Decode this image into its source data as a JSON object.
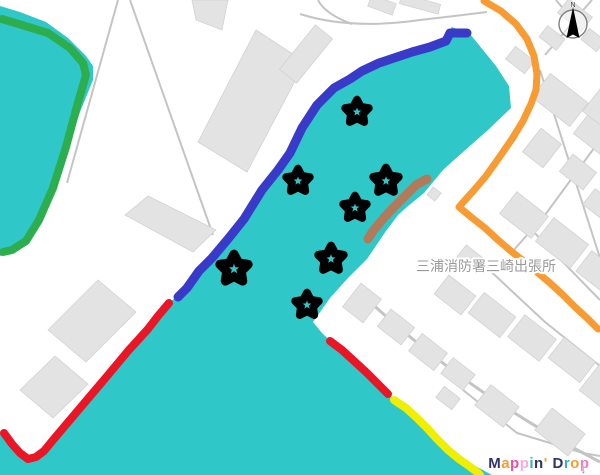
{
  "app": {
    "logo_letters": [
      {
        "ch": "M",
        "color": "#303264"
      },
      {
        "ch": "a",
        "color": "#F49D2C"
      },
      {
        "ch": "p",
        "color": "#EE4FA4"
      },
      {
        "ch": "p",
        "color": "#F7AEDC"
      },
      {
        "ch": "i",
        "color": "#33B6B2"
      },
      {
        "ch": "n",
        "color": "#303264"
      },
      {
        "ch": "'",
        "color": "#F49D2C"
      },
      {
        "ch": " ",
        "color": "#303264"
      },
      {
        "ch": "D",
        "color": "#303264"
      },
      {
        "ch": "r",
        "color": "#33B6B2"
      },
      {
        "ch": "o",
        "color": "#F49D2C"
      },
      {
        "ch": "p",
        "color": "#EE7BC8"
      }
    ],
    "logo_arrow": {
      "glyph": "↓",
      "color": "#33B6B2"
    }
  },
  "map": {
    "colors": {
      "water": "#2FC7C8",
      "land": "#FFFFFF",
      "building_fill": "#E3E3E3",
      "building_stroke": "#D2D2D2",
      "road": "#C4C4C4",
      "marker": "#000000"
    },
    "water_polygons": [
      {
        "name": "harbor-water",
        "points": [
          [
            452,
            27
          ],
          [
            470,
            34
          ],
          [
            496,
            66
          ],
          [
            509,
            86
          ],
          [
            511,
            108
          ],
          [
            488,
            130
          ],
          [
            463,
            152
          ],
          [
            443,
            170
          ],
          [
            424,
            193
          ],
          [
            408,
            206
          ],
          [
            398,
            215
          ],
          [
            386,
            231
          ],
          [
            367,
            259
          ],
          [
            348,
            278
          ],
          [
            330,
            298
          ],
          [
            313,
            322
          ],
          [
            322,
            333
          ],
          [
            342,
            352
          ],
          [
            365,
            372
          ],
          [
            390,
            397
          ],
          [
            418,
            424
          ],
          [
            443,
            444
          ],
          [
            468,
            462
          ],
          [
            492,
            475
          ],
          [
            0,
            475
          ],
          [
            0,
            434
          ],
          [
            12,
            441
          ],
          [
            24,
            452
          ],
          [
            35,
            458
          ],
          [
            45,
            454
          ],
          [
            56,
            442
          ],
          [
            70,
            424
          ],
          [
            90,
            400
          ],
          [
            110,
            372
          ],
          [
            131,
            347
          ],
          [
            152,
            326
          ],
          [
            168,
            303
          ],
          [
            178,
            296
          ],
          [
            191,
            279
          ],
          [
            202,
            270
          ],
          [
            213,
            257
          ],
          [
            227,
            238
          ],
          [
            243,
            218
          ],
          [
            262,
            188
          ],
          [
            278,
            167
          ],
          [
            289,
            154
          ],
          [
            301,
            128
          ],
          [
            317,
            103
          ],
          [
            334,
            86
          ],
          [
            350,
            77
          ],
          [
            362,
            69
          ],
          [
            379,
            60
          ],
          [
            394,
            56
          ],
          [
            413,
            49
          ],
          [
            431,
            44
          ],
          [
            447,
            40
          ],
          [
            447,
            33
          ]
        ]
      },
      {
        "name": "west-water",
        "points": [
          [
            0,
            6
          ],
          [
            20,
            12
          ],
          [
            46,
            22
          ],
          [
            68,
            38
          ],
          [
            86,
            56
          ],
          [
            93,
            66
          ],
          [
            93,
            80
          ],
          [
            80,
            112
          ],
          [
            68,
            150
          ],
          [
            55,
            190
          ],
          [
            40,
            222
          ],
          [
            25,
            243
          ],
          [
            10,
            252
          ],
          [
            0,
            256
          ]
        ]
      }
    ],
    "roads": [
      {
        "d": "M300,14 Q350,30 420,20 Q455,16 487,12",
        "w": 2
      },
      {
        "d": "M318,0 Q325,14 352,24",
        "w": 2
      },
      {
        "d": "M118,0 L67,183",
        "w": 2
      },
      {
        "d": "M130,0 L213,235",
        "w": 2
      },
      {
        "d": "M368,300 Q470,395 600,462",
        "w": 3
      },
      {
        "d": "M463,390 L517,433 L583,453 L600,456",
        "w": 2
      },
      {
        "d": "M540,70 L575,180 L600,258",
        "w": 2
      },
      {
        "d": "M520,218 L600,300",
        "w": 2
      },
      {
        "d": "M470,252 L545,322 L600,366",
        "w": 2
      },
      {
        "d": "M600,140 L545,215 L512,252",
        "w": 2
      },
      {
        "d": "M545,55 L578,16 L592,0",
        "w": 2
      },
      {
        "d": "M556,0 L571,18",
        "w": 2
      }
    ],
    "building_polygons": [
      [
        [
          198,
          142
        ],
        [
          256,
          30
        ],
        [
          305,
          62
        ],
        [
          247,
          172
        ]
      ],
      [
        [
          125,
          215
        ],
        [
          148,
          196
        ],
        [
          216,
          230
        ],
        [
          193,
          252
        ]
      ],
      [
        [
          48,
          330
        ],
        [
          98,
          280
        ],
        [
          136,
          312
        ],
        [
          86,
          362
        ]
      ],
      [
        [
          20,
          390
        ],
        [
          55,
          356
        ],
        [
          88,
          384
        ],
        [
          53,
          418
        ]
      ],
      [
        [
          192,
          0
        ],
        [
          228,
          0
        ],
        [
          222,
          30
        ],
        [
          196,
          20
        ]
      ]
    ],
    "building_rects": [
      [
        306,
        54,
        57,
        22,
        -51
      ],
      [
        382,
        5,
        26,
        12,
        20
      ],
      [
        420,
        4,
        40,
        10,
        15
      ],
      [
        575,
        15,
        30,
        18,
        38
      ],
      [
        552,
        38,
        22,
        14,
        38
      ],
      [
        593,
        40,
        20,
        14,
        38
      ],
      [
        560,
        100,
        48,
        30,
        38
      ],
      [
        595,
        135,
        36,
        24,
        38
      ],
      [
        542,
        148,
        26,
        30,
        38
      ],
      [
        578,
        172,
        30,
        22,
        38
      ],
      [
        604,
        105,
        26,
        36,
        38
      ],
      [
        520,
        60,
        24,
        16,
        38
      ],
      [
        524,
        215,
        40,
        28,
        38
      ],
      [
        562,
        243,
        44,
        30,
        38
      ],
      [
        598,
        272,
        36,
        26,
        38
      ],
      [
        600,
        205,
        28,
        20,
        38
      ],
      [
        470,
        258,
        22,
        16,
        38
      ],
      [
        455,
        295,
        34,
        24,
        38
      ],
      [
        492,
        315,
        40,
        26,
        38
      ],
      [
        532,
        338,
        40,
        28,
        38
      ],
      [
        572,
        360,
        40,
        26,
        38
      ],
      [
        605,
        385,
        34,
        40,
        38
      ],
      [
        362,
        303,
        26,
        30,
        38
      ],
      [
        396,
        327,
        30,
        22,
        38
      ],
      [
        428,
        352,
        32,
        22,
        38
      ],
      [
        458,
        374,
        28,
        20,
        38
      ],
      [
        497,
        406,
        36,
        26,
        38
      ],
      [
        560,
        432,
        42,
        28,
        38
      ],
      [
        448,
        398,
        20,
        14,
        38
      ],
      [
        434,
        194,
        10,
        10,
        38
      ]
    ],
    "routes": [
      {
        "name": "green-route",
        "color": "#2CAE4F",
        "width": 8,
        "points": [
          [
            2,
            19
          ],
          [
            22,
            25
          ],
          [
            48,
            33
          ],
          [
            70,
            48
          ],
          [
            83,
            63
          ],
          [
            86,
            75
          ],
          [
            77,
            106
          ],
          [
            66,
            147
          ],
          [
            53,
            188
          ],
          [
            39,
            220
          ],
          [
            26,
            241
          ],
          [
            12,
            250
          ],
          [
            3,
            252
          ]
        ]
      },
      {
        "name": "blue-route",
        "color": "#3A3AC8",
        "width": 9,
        "points": [
          [
            467,
            33
          ],
          [
            450,
            33
          ],
          [
            446,
            41
          ],
          [
            430,
            47
          ],
          [
            412,
            52
          ],
          [
            394,
            58
          ],
          [
            379,
            63
          ],
          [
            362,
            71
          ],
          [
            350,
            79
          ],
          [
            334,
            88
          ],
          [
            317,
            105
          ],
          [
            302,
            128
          ],
          [
            290,
            153
          ],
          [
            278,
            170
          ],
          [
            262,
            190
          ],
          [
            244,
            219
          ],
          [
            228,
            239
          ],
          [
            212,
            258
          ],
          [
            199,
            271
          ],
          [
            187,
            288
          ],
          [
            178,
            297
          ]
        ]
      },
      {
        "name": "red-route-west",
        "color": "#EA1525",
        "width": 8,
        "points": [
          [
            169,
            303
          ],
          [
            158,
            316
          ],
          [
            148,
            329
          ],
          [
            128,
            351
          ],
          [
            108,
            375
          ],
          [
            86,
            401
          ],
          [
            64,
            427
          ],
          [
            53,
            440
          ],
          [
            44,
            451
          ],
          [
            36,
            457
          ],
          [
            28,
            459
          ],
          [
            20,
            453
          ],
          [
            12,
            444
          ],
          [
            4,
            433
          ]
        ]
      },
      {
        "name": "red-route-east",
        "color": "#EA1525",
        "width": 8,
        "points": [
          [
            330,
            341
          ],
          [
            342,
            350
          ],
          [
            354,
            361
          ],
          [
            366,
            372
          ],
          [
            378,
            384
          ],
          [
            388,
            394
          ]
        ]
      },
      {
        "name": "yellow-route",
        "color": "#F0EF00",
        "width": 8,
        "points": [
          [
            394,
            400
          ],
          [
            406,
            408
          ],
          [
            417,
            418
          ],
          [
            427,
            428
          ],
          [
            437,
            439
          ],
          [
            448,
            450
          ],
          [
            459,
            459
          ],
          [
            469,
            466
          ],
          [
            477,
            472
          ],
          [
            480,
            475
          ]
        ]
      },
      {
        "name": "orange-route",
        "color": "#F89B33",
        "width": 7,
        "points": [
          [
            484,
            1
          ],
          [
            501,
            11
          ],
          [
            516,
            24
          ],
          [
            527,
            39
          ],
          [
            534,
            56
          ],
          [
            537,
            74
          ],
          [
            536,
            90
          ],
          [
            531,
            104
          ],
          [
            523,
            121
          ],
          [
            512,
            139
          ],
          [
            503,
            152
          ],
          [
            496,
            162
          ],
          [
            486,
            176
          ],
          [
            475,
            189
          ],
          [
            466,
            199
          ],
          [
            459,
            207
          ],
          [
            471,
            217
          ],
          [
            485,
            228
          ],
          [
            498,
            240
          ],
          [
            512,
            252
          ],
          [
            525,
            262
          ],
          [
            538,
            273
          ],
          [
            550,
            283
          ],
          [
            563,
            295
          ],
          [
            575,
            307
          ],
          [
            587,
            318
          ],
          [
            598,
            329
          ]
        ]
      },
      {
        "name": "tan-route",
        "color": "#B17A5B",
        "width": 9,
        "points": [
          [
            427,
            179
          ],
          [
            416,
            185
          ],
          [
            404,
            197
          ],
          [
            392,
            209
          ],
          [
            382,
            220
          ],
          [
            373,
            231
          ],
          [
            368,
            239
          ]
        ]
      }
    ],
    "markers": {
      "shape": "star",
      "color": "#000000",
      "hole_color": "#2FC7C8",
      "positions": [
        [
          357,
          112,
          16
        ],
        [
          298,
          181,
          16
        ],
        [
          386,
          181,
          17
        ],
        [
          355,
          208,
          16
        ],
        [
          234,
          269,
          19
        ],
        [
          331,
          259,
          17
        ],
        [
          307,
          305,
          16
        ]
      ]
    },
    "label": {
      "text": "三浦消防署三崎出張所",
      "x": 486,
      "y": 271,
      "size": 14,
      "color": "#9A9A9A",
      "halo": "#FFFFFF"
    },
    "compass": {
      "x": 573,
      "y": 24,
      "r": 14,
      "letter": "N",
      "needle_color": "#000000",
      "ring_color": "#808080",
      "letter_color": "#444444"
    }
  }
}
